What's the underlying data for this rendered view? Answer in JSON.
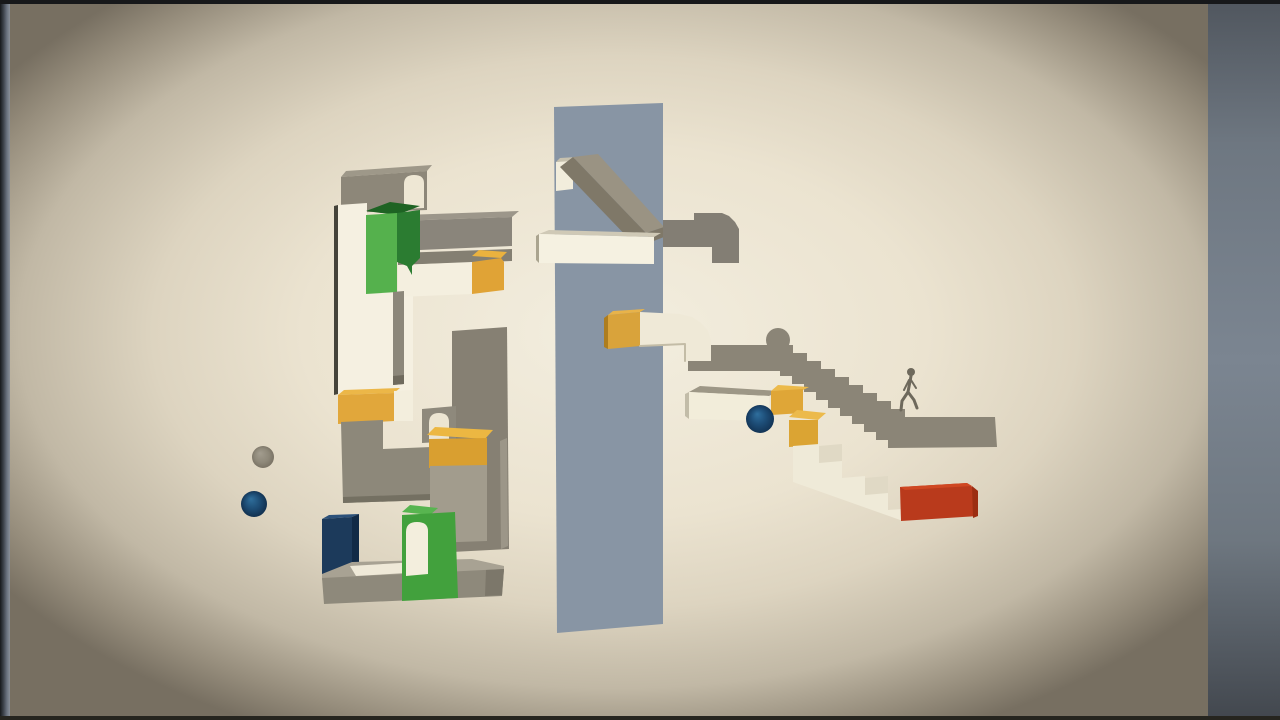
{
  "scene": {
    "description": "minimal-3d-block-puzzle-game-frame",
    "canvas": {
      "width": 1280,
      "height": 720
    },
    "palette": {
      "background_cream": "#ece4d1",
      "vignette_dark": "#776f61",
      "pillar_blue_gray": "#8895a4",
      "block_white": "#f5f0e1",
      "block_gray": "#8b8577",
      "accent_green": "#55b14d",
      "accent_orange": "#e1a73b",
      "accent_navy": "#1c3a5b",
      "accent_red": "#b93a1c",
      "sphere_blue": "#1d4d77",
      "sphere_gray": "#8e8879",
      "letterbox_gray": "#7b8591"
    },
    "gradients": [
      {
        "id": "gVig",
        "kind": "radial",
        "attrs": {
          "cx": "50.5%",
          "cy": "46%",
          "r": "62%"
        },
        "stops": [
          [
            0,
            "#f3eedf"
          ],
          [
            0.42,
            "#ebe3d0"
          ],
          [
            0.62,
            "#ddd4c0"
          ],
          [
            0.8,
            "#c1b8a5"
          ],
          [
            0.92,
            "#968d7c"
          ],
          [
            1,
            "#776f61"
          ]
        ]
      },
      {
        "id": "gLeft",
        "kind": "linear",
        "attrs": {
          "x1": "0",
          "y1": "0",
          "x2": "1",
          "y2": "0"
        },
        "stops": [
          [
            0,
            "#17191c"
          ],
          [
            0.35,
            "#3d434b"
          ],
          [
            0.7,
            "#6b7380"
          ],
          [
            1,
            "#8a9099"
          ]
        ]
      },
      {
        "id": "gRight",
        "kind": "linear",
        "attrs": {
          "x1": "0",
          "y1": "0",
          "x2": "0",
          "y2": "1"
        },
        "stops": [
          [
            0,
            "#50565e"
          ],
          [
            0.2,
            "#6e7781"
          ],
          [
            0.5,
            "#7b8591"
          ],
          [
            0.75,
            "#6e7780"
          ],
          [
            1,
            "#42474e"
          ]
        ]
      },
      {
        "id": "gGraySph",
        "kind": "radial",
        "attrs": {
          "cx": "50%",
          "cy": "50%",
          "r": "55%",
          "fx": "36%",
          "fy": "32%"
        },
        "stops": [
          [
            0,
            "#a39d8f"
          ],
          [
            0.6,
            "#8e8879"
          ],
          [
            1,
            "#766f61"
          ]
        ]
      },
      {
        "id": "gBlueSph",
        "kind": "radial",
        "attrs": {
          "cx": "50%",
          "cy": "50%",
          "r": "55%",
          "fx": "38%",
          "fy": "30%"
        },
        "stops": [
          [
            0,
            "#2f6f9c"
          ],
          [
            0.55,
            "#1c4b73"
          ],
          [
            1,
            "#102c49"
          ]
        ]
      },
      {
        "id": "gBlueSph2",
        "kind": "radial",
        "attrs": {
          "cx": "50%",
          "cy": "50%",
          "r": "55%",
          "fx": "40%",
          "fy": "32%"
        },
        "stops": [
          [
            0,
            "#2f6f9e"
          ],
          [
            0.5,
            "#1d4d77"
          ],
          [
            1,
            "#113050"
          ]
        ]
      }
    ],
    "shapes": [
      {
        "name": "frame-background",
        "type": "rect",
        "x": 0,
        "y": 0,
        "w": 1280,
        "h": 720,
        "fill": "#101113"
      },
      {
        "name": "room-background-vignette",
        "type": "rect",
        "x": 8,
        "y": 2,
        "w": 1202,
        "h": 718,
        "fill": "url(#gVig)"
      },
      {
        "name": "letterbox-left-bar",
        "type": "rect",
        "x": 0,
        "y": 0,
        "w": 10,
        "h": 720,
        "fill": "url(#gLeft)"
      },
      {
        "name": "letterbox-right-bar",
        "type": "rect",
        "x": 1208,
        "y": 0,
        "w": 72,
        "h": 720,
        "fill": "url(#gRight)"
      },
      {
        "name": "frame-top-edge",
        "type": "rect",
        "x": 0,
        "y": 0,
        "w": 1280,
        "h": 4,
        "fill": "#17181a"
      },
      {
        "name": "frame-bottom-edge",
        "type": "rect",
        "x": 0,
        "y": 716,
        "w": 1280,
        "h": 4,
        "fill": "#26251f"
      },
      {
        "name": "left-top-gray-block-top",
        "type": "polygon",
        "pts": "341,177 346,171 432,165 427,171",
        "fill": "#9e9889"
      },
      {
        "name": "left-top-gray-block-front",
        "type": "polygon",
        "pts": "341,177 427,171 427,210 341,213",
        "fill": "#8d8779"
      },
      {
        "name": "left-top-arch-doorway",
        "type": "path",
        "d": "M404,209 L404,184 Q404,175 414,175 Q424,175 424,183 L424,208 Z",
        "fill": "#eee7d4"
      },
      {
        "name": "white-column-left-edge",
        "type": "polygon",
        "pts": "334,206 338,205 338,394 334,395",
        "fill": "#45433a"
      },
      {
        "name": "white-column",
        "type": "path",
        "d": "M338,205 L367,203 L367,292 L413,291 L413,391 L338,394 Z",
        "fill": "#f5f0e1"
      },
      {
        "name": "gray-beam-top",
        "type": "polygon",
        "pts": "397,221 404,215 519,211 512,217",
        "fill": "#9c968a"
      },
      {
        "name": "gray-beam-front",
        "type": "polygon",
        "pts": "397,221 512,217 512,246 397,251",
        "fill": "#8a857b"
      },
      {
        "name": "white-beam-shadow-top",
        "type": "polygon",
        "pts": "398,253 512,249 512,261 398,265",
        "fill": "#847f72"
      },
      {
        "name": "white-beam-front",
        "type": "polygon",
        "pts": "398,265 472,262 472,294 398,297",
        "fill": "#f4efdf"
      },
      {
        "name": "white-beam-orange-cap-top",
        "type": "polygon",
        "pts": "472,256 479,250 507,252 501,258",
        "fill": "#eab23f"
      },
      {
        "name": "white-beam-orange-cap-front",
        "type": "polygon",
        "pts": "472,262 501,258 504,262 504,290 472,294",
        "fill": "#e0a336"
      },
      {
        "name": "green-block-top-face",
        "type": "polygon",
        "pts": "366,211 390,202 420,206 397,215",
        "fill": "#1e6323"
      },
      {
        "name": "green-block-front",
        "type": "polygon",
        "pts": "366,215 397,213 397,292 366,294",
        "fill": "#55b14d"
      },
      {
        "name": "green-block-side-drip",
        "type": "path",
        "d": "M397,213 L420,210 L420,258 L412,266 L412,275 L407,266 L397,262 Z",
        "fill": "#2b7c31"
      },
      {
        "name": "hanging-gray-rod",
        "type": "polygon",
        "pts": "393,292 404,291 404,384 393,385",
        "fill": "#8c877a"
      },
      {
        "name": "hanging-gray-rod-tip",
        "type": "polygon",
        "pts": "393,376 404,375 404,384 393,385",
        "fill": "#6f6a5d"
      },
      {
        "name": "column-orange-cap-top",
        "type": "polygon",
        "pts": "338,395 344,390 400,388 394,393",
        "fill": "#ecb748"
      },
      {
        "name": "column-orange-cap-front",
        "type": "polygon",
        "pts": "338,395 394,393 394,421 338,424",
        "fill": "#e1a73b"
      },
      {
        "name": "column-white-sliver",
        "type": "polygon",
        "pts": "394,391 413,390 413,421 394,421",
        "fill": "#f3eedd"
      },
      {
        "name": "tall-gray-column",
        "type": "polygon",
        "pts": "452,331 507,327 509,549 452,552",
        "fill": "#868073"
      },
      {
        "name": "tall-gray-column-light-edge",
        "type": "polygon",
        "pts": "500,441 507,438 508,546 501,549",
        "fill": "#9c9688"
      },
      {
        "name": "small-arch-block",
        "type": "polygon",
        "pts": "422,409 456,406 456,441 422,443",
        "fill": "#8e897c"
      },
      {
        "name": "small-arch-doorway",
        "type": "path",
        "d": "M429,441 L429,423 Q429,413 439,413 Q449,413 449,422 L449,440 Z",
        "fill": "#ece5d2"
      },
      {
        "name": "gray-elbow-pipe-left",
        "type": "path",
        "d": "M341,422 L383,420 L383,449 L431,447 L431,500 L343,503 Z",
        "fill": "#8d887a"
      },
      {
        "name": "gray-elbow-pipe-left-underside",
        "type": "polygon",
        "pts": "343,497 431,494 431,500 343,503",
        "fill": "#747062"
      },
      {
        "name": "mid-orange-cap-top",
        "type": "polygon",
        "pts": "427,435 435,427 493,430 485,439",
        "fill": "#ecb742"
      },
      {
        "name": "mid-orange-cap-front",
        "type": "polygon",
        "pts": "429,439 487,438 487,466 429,468",
        "fill": "#d99f30"
      },
      {
        "name": "gray-column-below-cap",
        "type": "polygon",
        "pts": "430,466 487,465 487,541 430,543",
        "fill": "#a29c8d"
      },
      {
        "name": "navy-block-top",
        "type": "polygon",
        "pts": "322,519 329,515 359,514 352,517",
        "fill": "#2c517a"
      },
      {
        "name": "navy-block-front",
        "type": "polygon",
        "pts": "322,519 352,517 352,577 322,580",
        "fill": "#1c3a5b"
      },
      {
        "name": "navy-block-side",
        "type": "polygon",
        "pts": "352,517 359,514 359,573 352,577",
        "fill": "#112a46"
      },
      {
        "name": "base-platform-top",
        "type": "polygon",
        "pts": "322,574 352,562 472,559 504,566 504,572 322,580",
        "fill": "#a8a293"
      },
      {
        "name": "base-platform-top-highlight",
        "type": "polygon",
        "pts": "350,566 434,561 440,571 356,576",
        "fill": "#efe9d8"
      },
      {
        "name": "base-platform-front",
        "type": "polygon",
        "pts": "322,578 504,569 502,596 324,604",
        "fill": "#8e897b"
      },
      {
        "name": "base-platform-right-cap",
        "type": "polygon",
        "pts": "486,570 504,569 502,595 485,596",
        "fill": "#7c776a"
      },
      {
        "name": "green-arch-block-top",
        "type": "polygon",
        "pts": "402,512 410,505 438,508 430,515",
        "fill": "#58b550"
      },
      {
        "name": "green-arch-block-front",
        "type": "polygon",
        "pts": "402,515 455,512 458,598 402,601",
        "fill": "#42a13d"
      },
      {
        "name": "green-arch-doorway",
        "type": "path",
        "d": "M406,576 L406,532 Q406,522 417,522 Q428,522 428,531 L428,574 Z",
        "fill": "#f3eedd"
      },
      {
        "name": "gray-sphere-left",
        "type": "circle",
        "cx": 263,
        "cy": 457,
        "r": 11,
        "fill": "url(#gGraySph)"
      },
      {
        "name": "blue-sphere-left",
        "type": "circle",
        "cx": 254,
        "cy": 504,
        "r": 13,
        "fill": "url(#gBlueSph)"
      },
      {
        "name": "center-pillar",
        "type": "polygon",
        "pts": "554,107 663,103 663,624 557,633",
        "fill": "#8895a4"
      },
      {
        "name": "pillar-white-block-front",
        "type": "polygon",
        "pts": "556,162 573,160 573,189 556,191",
        "fill": "#f2eddc"
      },
      {
        "name": "pillar-white-block-top",
        "type": "polygon",
        "pts": "556,162 560,158 577,157 573,161",
        "fill": "#c7c1ae"
      },
      {
        "name": "gray-ramp-top",
        "type": "polygon",
        "pts": "573,157 598,154 664,227 646,233",
        "fill": "#9a9383"
      },
      {
        "name": "gray-ramp-front",
        "type": "polygon",
        "pts": "573,157 646,233 633,243 560,167",
        "fill": "#7f7868"
      },
      {
        "name": "gray-ramp-foot",
        "type": "polygon",
        "pts": "646,233 664,227 664,237 651,242",
        "fill": "#7f7868"
      },
      {
        "name": "center-white-beam-top",
        "type": "polygon",
        "pts": "539,234 549,230 661,233 654,237",
        "fill": "#cfc9b6"
      },
      {
        "name": "center-white-beam-left-cap",
        "type": "polygon",
        "pts": "536,236 539,234 539,263 536,260",
        "fill": "#aaa48f"
      },
      {
        "name": "center-white-beam-front",
        "type": "polygon",
        "pts": "539,234 654,237 654,264 539,263",
        "fill": "#f5f1e1"
      },
      {
        "name": "gray-elbow-pipe-right",
        "type": "path",
        "d": "M663,220 L694,220 L694,213 L722,213 L729,216 L735,222 L739,229 L739,263 L712,263 L712,247 L663,247 Z",
        "fill": "#837e74"
      },
      {
        "name": "silhouette-bump",
        "type": "circle",
        "cx": 778,
        "cy": 340,
        "r": 12,
        "fill": "#8b8577"
      },
      {
        "name": "silhouette-staircase",
        "type": "path",
        "d": "M688,345 L793,345 L793,353 L807,353 L807,361 L821,361 L821,369 L835,369 L835,377 L849,377 L849,385 L863,385 L863,393 L877,393 L877,401 L891,401 L891,409 L905,409 L905,417 L995,417 L997,447 L888,448 L888,440 L876,440 L876,432 L864,432 L864,424 L852,424 L852,416 L840,416 L840,408 L828,408 L828,400 L816,400 L816,392 L804,392 L804,384 L792,384 L792,376 L780,376 L780,371 L688,371 Z",
        "fill": "#8b8577"
      },
      {
        "name": "figure-head",
        "type": "circle",
        "cx": 911,
        "cy": 372,
        "r": 4,
        "fill": "#6e695c"
      },
      {
        "name": "figure-torso",
        "type": "path",
        "d": "M911,376 L908,392",
        "stroke": "#6e695c",
        "sw": 3,
        "fill": "none"
      },
      {
        "name": "figure-arm-left",
        "type": "path",
        "d": "M909,380 L904,390",
        "stroke": "#6e695c",
        "sw": 2,
        "fill": "none"
      },
      {
        "name": "figure-arm-right",
        "type": "path",
        "d": "M911,380 L916,388",
        "stroke": "#6e695c",
        "sw": 2,
        "fill": "none"
      },
      {
        "name": "figure-leg-left",
        "type": "path",
        "d": "M908,392 L902,401 L901,410",
        "stroke": "#6e695c",
        "sw": 3,
        "fill": "none"
      },
      {
        "name": "figure-leg-right",
        "type": "path",
        "d": "M908,392 L914,400 L917,408",
        "stroke": "#6e695c",
        "sw": 3,
        "fill": "none"
      },
      {
        "name": "pipe-orange-cap-side",
        "type": "polygon",
        "pts": "604,318 608,315 608,349 604,347",
        "fill": "#ad7d1f"
      },
      {
        "name": "pipe-orange-cap-front",
        "type": "polygon",
        "pts": "608,315 640,312 640,346 608,349",
        "fill": "#d9a33b"
      },
      {
        "name": "pipe-orange-cap-top",
        "type": "polygon",
        "pts": "608,315 613,311 645,309 640,312",
        "fill": "#e8b34a"
      },
      {
        "name": "white-curved-pipe",
        "type": "path",
        "d": "M640,312 L680,314 L692,317 L701,323 L708,331 L711,340 L711,361 L685,361 L685,344 L640,346 Z",
        "fill": "#efe9d7"
      },
      {
        "name": "white-curved-pipe-shade",
        "type": "path",
        "d": "M640,346 L685,344 L685,361",
        "stroke": "#c3bca6",
        "sw": 2,
        "fill": "none"
      },
      {
        "name": "right-white-beam-top",
        "type": "polygon",
        "pts": "689,392 700,386 779,391 769,396",
        "fill": "#9d9786"
      },
      {
        "name": "right-white-beam-left-cap",
        "type": "polygon",
        "pts": "685,394 689,392 689,419 685,416",
        "fill": "#c2bca8"
      },
      {
        "name": "right-white-beam-front",
        "type": "polygon",
        "pts": "689,392 769,396 769,421 689,419",
        "fill": "#f2edda"
      },
      {
        "name": "right-orange-cube-a-top",
        "type": "polygon",
        "pts": "771,391 778,385 809,387 803,390",
        "fill": "#ecba4b"
      },
      {
        "name": "right-orange-cube-a-front",
        "type": "polygon",
        "pts": "771,391 803,389 803,413 771,415",
        "fill": "#dfa637"
      },
      {
        "name": "blue-sphere-right",
        "type": "circle",
        "cx": 760,
        "cy": 419,
        "r": 14,
        "fill": "url(#gBlueSph2)"
      },
      {
        "name": "right-orange-cube-b-top",
        "type": "polygon",
        "pts": "789,417 797,410 826,413 818,420",
        "fill": "#ecba4b"
      },
      {
        "name": "right-orange-cube-b-front",
        "type": "polygon",
        "pts": "789,420 818,420 818,445 789,447",
        "fill": "#dba433"
      },
      {
        "name": "white-staircase",
        "type": "path",
        "d": "M793,446 L819,444 L819,462 L842,460 L842,478 L865,476 L865,494 L888,492 L888,510 L903,509 L903,521 L793,482 Z",
        "fill": "#efead8"
      },
      {
        "name": "white-staircase-shade-1",
        "type": "polygon",
        "pts": "819,446 842,444 842,461 819,463",
        "fill": "#e0d9c5"
      },
      {
        "name": "white-staircase-shade-2",
        "type": "polygon",
        "pts": "865,478 888,476 888,493 865,495",
        "fill": "#e0d9c5"
      },
      {
        "name": "red-block-front",
        "type": "polygon",
        "pts": "900,487 967,483 978,491 978,516 901,521",
        "fill": "#b93a1c"
      },
      {
        "name": "red-block-top",
        "type": "polygon",
        "pts": "900,487 967,483 972,486 905,490",
        "fill": "#cf4722"
      },
      {
        "name": "red-block-right-side",
        "type": "polygon",
        "pts": "972,486 978,491 978,516 973,518",
        "fill": "#9c2e12"
      }
    ]
  }
}
